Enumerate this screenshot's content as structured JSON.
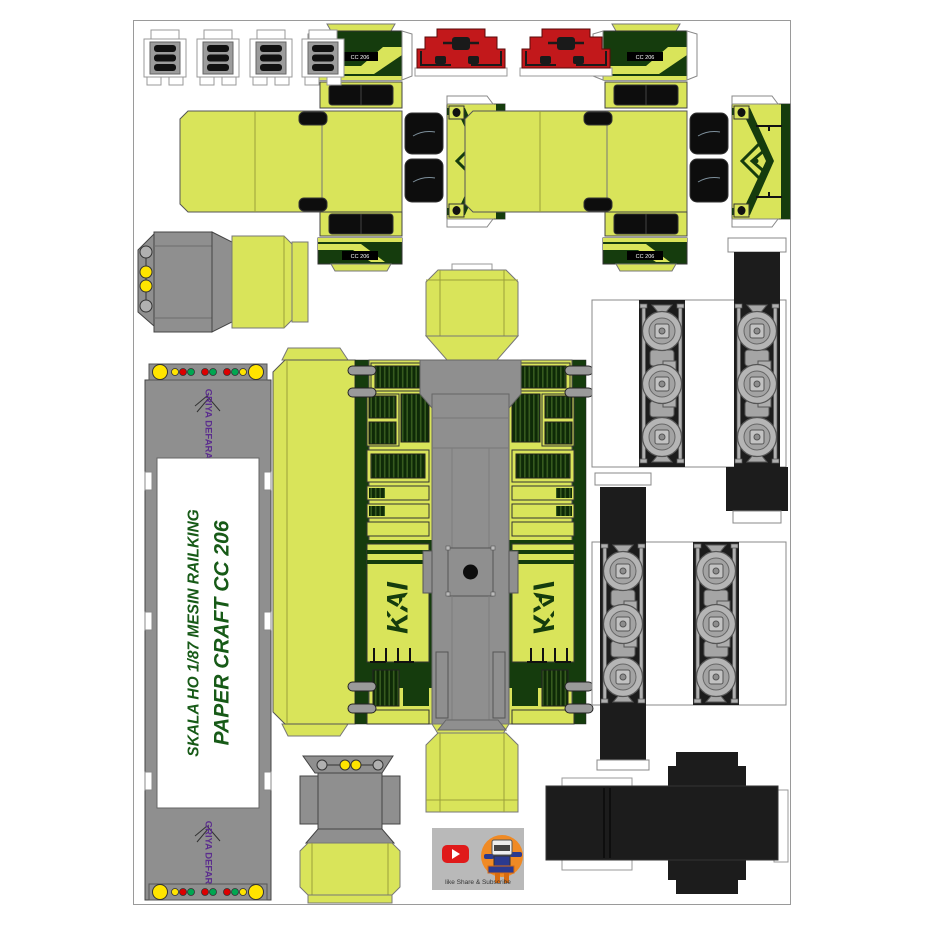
{
  "document": {
    "kind": "papercraft template sheet",
    "model": "Lokomotif CC 206",
    "scale": "HO 1/87"
  },
  "texts": {
    "title_line1": "PAPER CRAFT CC 206",
    "title_line2": "SKALA HO 1/87 MESIN RAILKING",
    "maker_logo": "GRIYA DEFARA",
    "cab_number": "CC 206",
    "kai_logo": "KAI",
    "subscribe": "like Share & Subscribe"
  },
  "palette": {
    "body_chartreuse": "#d9e45a",
    "dark_green": "#153c0d",
    "horn_red": "#c2181b",
    "roof_gray": "#8f8f8f",
    "tank_black": "#1c1c1c",
    "logo_purple": "#5b2d8e",
    "title_green": "#175a17",
    "dot_yellow": "#ffe400",
    "dot_red": "#dd0000",
    "dot_green": "#00a651"
  },
  "parts": [
    "radiator-grille-x4",
    "cab-end-left",
    "cab-end-right",
    "horn-roof-cap-x2",
    "front-pilot-upper",
    "front-pilot-lower",
    "chassis-strip",
    "main-hood-and-roof",
    "cab-roof-box-top",
    "cab-roof-box-bottom",
    "bogie-sideframes-x4",
    "fuel-tank",
    "youtube-promo"
  ]
}
